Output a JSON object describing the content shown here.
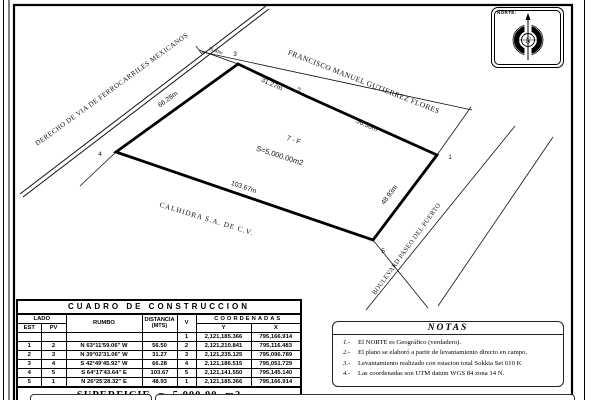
{
  "drawing": {
    "north": {
      "label": "NORTE:",
      "letter": "N"
    },
    "streets": {
      "railroad": "DERECHO DE VIA DE FERROCARRILES MEXICANOS",
      "north_street": "FRANCISCO MANUEL GUTIERREZ FLORES",
      "south_owner": "CALHIDRA S.A. DE C.V.",
      "boulevard": "BOULEVARD PASEO DEL PUERTO"
    },
    "labels": {
      "lot": "7 - F",
      "area": "S=5,000.00m2",
      "edge_1_2": "56.50m",
      "edge_2_3": "31.27m",
      "edge_3_4": "66.28m",
      "edge_4_5": "103.67m",
      "edge_5_1": "48.93m",
      "offset": "15.00m"
    },
    "vertices": {
      "v1": "1",
      "v2": "2",
      "v3": "3",
      "v4": "4",
      "v5": "5"
    }
  },
  "table": {
    "title": "CUADRO DE CONSTRUCCION",
    "headers": {
      "lado": "LADO",
      "est": "EST",
      "pv": "PV",
      "rumbo": "RUMBO",
      "distancia": "DISTANCIA",
      "mts": "(MTS)",
      "v": "V",
      "coordenadas": "COORDENADAS",
      "y": "Y",
      "x": "X"
    },
    "rows": [
      {
        "est": "",
        "pv": "",
        "rumbo": "",
        "dist": "",
        "v": "1",
        "y": "2,121,185.366",
        "x": "795,166.914"
      },
      {
        "est": "1",
        "pv": "2",
        "rumbo": "N 63°11'59.06\" W",
        "dist": "56.50",
        "v": "2",
        "y": "2,121,210.841",
        "x": "795,116.483"
      },
      {
        "est": "2",
        "pv": "3",
        "rumbo": "N 39°02'31.06\" W",
        "dist": "31.27",
        "v": "3",
        "y": "2,121,235.125",
        "x": "795,096.789"
      },
      {
        "est": "3",
        "pv": "4",
        "rumbo": "S 42°49'45.92\" W",
        "dist": "66.28",
        "v": "4",
        "y": "2,121,186.515",
        "x": "795,051.729"
      },
      {
        "est": "4",
        "pv": "5",
        "rumbo": "S 64°17'43.64\" E",
        "dist": "103.67",
        "v": "5",
        "y": "2,121,141.550",
        "x": "795,145.140"
      },
      {
        "est": "5",
        "pv": "1",
        "rumbo": "N 26°25'28.32\" E",
        "dist": "48.93",
        "v": "1",
        "y": "2,121,185.366",
        "x": "795,166.914"
      }
    ],
    "superficie": "SUPERFICIE = 5,000.00 m2"
  },
  "notes": {
    "title": "NOTAS",
    "items": [
      {
        "num": "1.-",
        "text": "El NORTE es Geográfico (verdadero)."
      },
      {
        "num": "2.-",
        "text": "El plano se elaboró a partir de levantamiento directo en campo."
      },
      {
        "num": "3.-",
        "text": "Levantamiento realizado con estacion total Sokkia Set 610 K"
      },
      {
        "num": "4.-",
        "text": "Las coordenadas son UTM datum WGS 84 zona 14 N."
      }
    ]
  }
}
